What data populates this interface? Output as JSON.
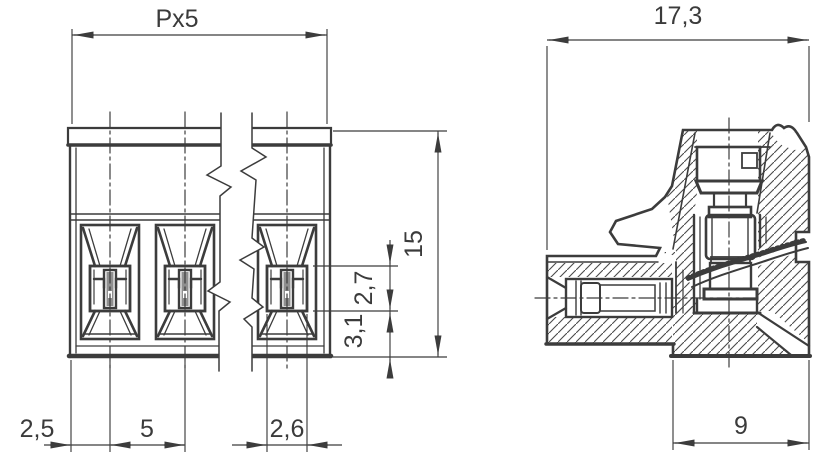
{
  "drawing": {
    "type": "technical-dimension-drawing",
    "subject": "pluggable screw terminal block – front view and side section view",
    "background": "#ffffff",
    "line_color": "#3c3c3c",
    "slot_fill": "#8f8f8f",
    "views": [
      {
        "id": "front-view",
        "description": "front view, 3 clamp poles shown with break lines"
      },
      {
        "id": "side-view",
        "description": "side cross-section with screw clamp and wire entry"
      }
    ],
    "dimensions": {
      "front": {
        "overall_pitch": "Px5",
        "overall_height": "15",
        "clamp_window_height": "2,7",
        "lower_zone_height": "3,1",
        "edge_to_first_pole": "2,5",
        "pole_pitch": "5",
        "clamp_window_width": "2,6"
      },
      "side": {
        "overall_depth": "17,3",
        "base_depth": "9"
      }
    }
  }
}
